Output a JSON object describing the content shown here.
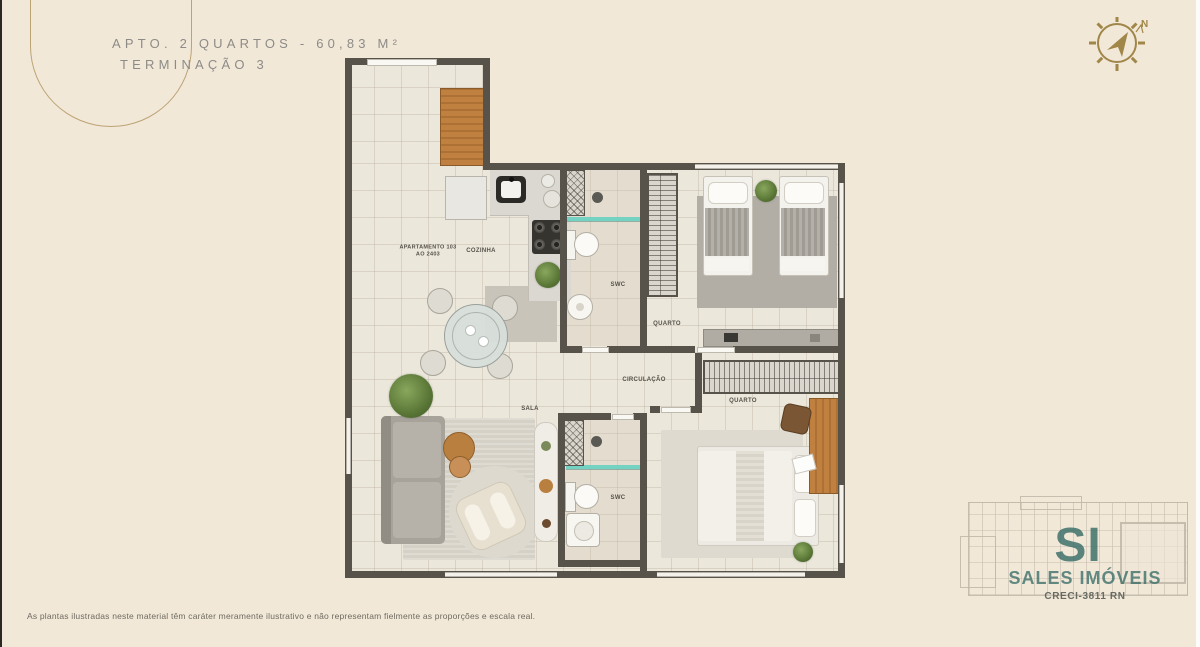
{
  "header": {
    "title": "APTO. 2 QUARTOS - 60,83 M²",
    "subtitle": "TERMINAÇÃO 3"
  },
  "compass": {
    "north": "N"
  },
  "plan": {
    "labels": {
      "apartment_line1": "APARTAMENTO 103",
      "apartment_line2": "AO 2403",
      "kitchen": "COZINHA",
      "bath_top": "SWC",
      "bedroom_top": "QUARTO",
      "hall": "CIRCULAÇÃO",
      "bedroom_bottom": "QUARTO",
      "bath_bottom": "SWC",
      "living": "SALA"
    }
  },
  "watermark": {
    "initials": "SI",
    "name": "SALES IMÓVEIS",
    "creci": "CRECI-3811 RN"
  },
  "footer": {
    "disclaimer": "As plantas ilustradas neste material têm caráter meramente ilustrativo e não representam fielmente as proporções e escala real."
  },
  "colors": {
    "background": "#f2e8d8",
    "wall": "#57534b",
    "gold": "#ab8c55",
    "teal": "#74d2c2",
    "wm_teal": "#3d7670",
    "wood": "#c08040"
  }
}
